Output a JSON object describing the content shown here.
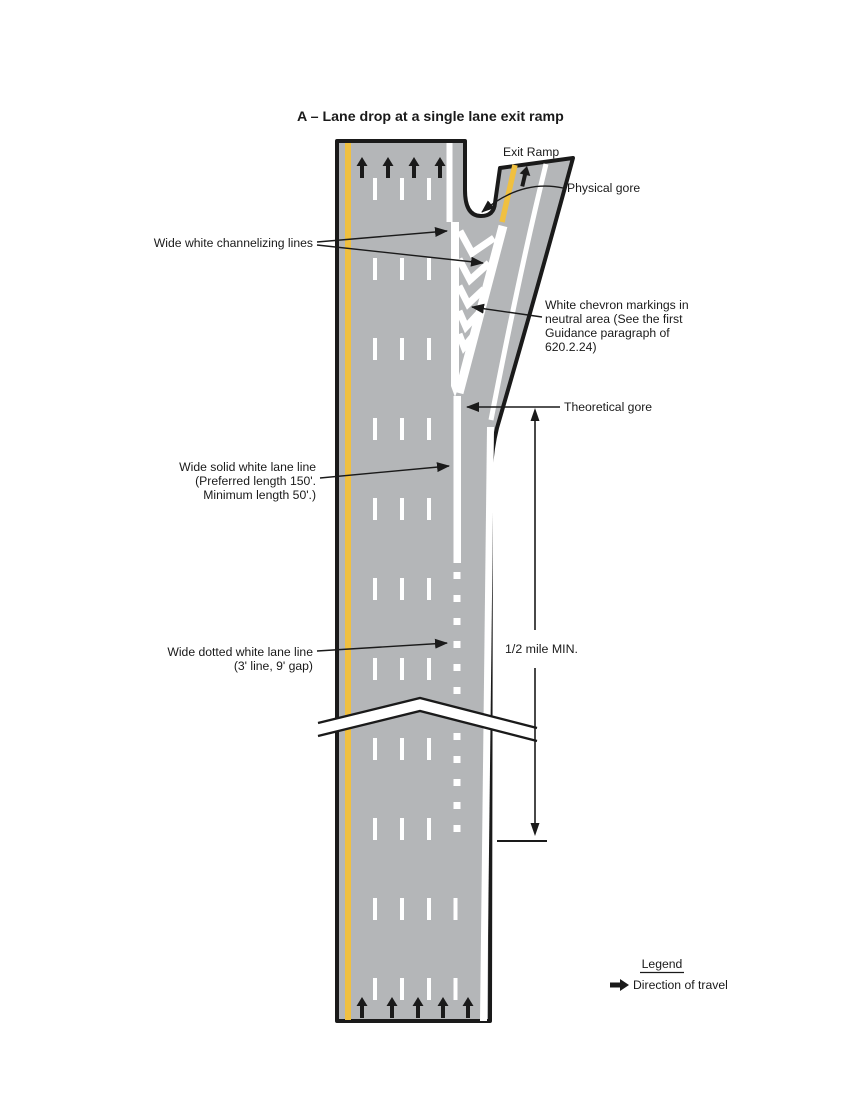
{
  "title": "A – Lane drop at a single lane exit ramp",
  "exit_ramp_label": "Exit Ramp",
  "labels": {
    "physical_gore": "Physical gore",
    "channelizing": "Wide white channelizing lines",
    "chevron_line1": "White chevron markings in",
    "chevron_line2": "neutral area (See the first",
    "chevron_line3": "Guidance paragraph of",
    "chevron_line4": "620.2.24)",
    "theoretical_gore": "Theoretical gore",
    "solid_line1": "Wide solid white lane line",
    "solid_line2": "(Preferred length 150'.",
    "solid_line3": "Minimum length 50'.)",
    "dotted_line1": "Wide dotted white lane line",
    "dotted_line2": "(3' line, 9' gap)",
    "half_mile": "1/2 mile MIN."
  },
  "legend": {
    "title": "Legend",
    "direction": "Direction of travel"
  },
  "colors": {
    "pavement": "#b4b6b8",
    "yellow_line": "#f0c040",
    "marking_white": "#ffffff",
    "line_black": "#1a1a1a"
  }
}
